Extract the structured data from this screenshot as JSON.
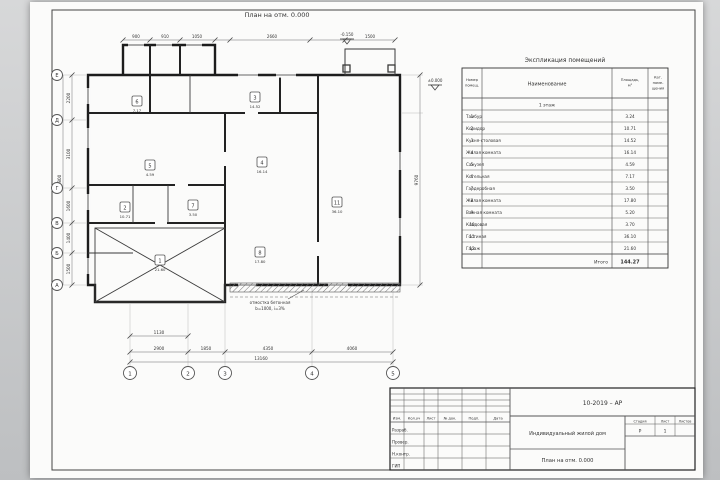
{
  "page": {
    "background": "#c6c8ca",
    "paper": "#fbfbfa"
  },
  "drawing_title": "План на отм. 0.000",
  "plan": {
    "axes_bottom": [
      "1",
      "2",
      "3",
      "4",
      "5"
    ],
    "axes_left": [
      "Е",
      "Д",
      "Г",
      "В",
      "Б",
      "А"
    ],
    "dims_top": [
      "900",
      "910",
      "1050",
      "2660",
      "1500"
    ],
    "dims_bottom": [
      "2900",
      "1850",
      "4350",
      "4060"
    ],
    "dim_bottom_total": "13160",
    "dim_extra": "1130",
    "dims_left": [
      "2200",
      "3100",
      "1600",
      "1400",
      "1500"
    ],
    "dim_left_total": "9800",
    "dim_right_total": "9760",
    "levels": [
      "±0.000",
      "-0.150"
    ],
    "note_line1": "отмостка бетонная",
    "note_line2": "b=1000, i=3%",
    "rooms": [
      {
        "n": "6",
        "a": "7.17"
      },
      {
        "n": "3",
        "a": "14.52"
      },
      {
        "n": "5",
        "a": "4.59"
      },
      {
        "n": "4",
        "a": "16.14"
      },
      {
        "n": "2",
        "a": "10.71"
      },
      {
        "n": "7",
        "a": "3.50"
      },
      {
        "n": "8",
        "a": "17.80"
      },
      {
        "n": "11",
        "a": "36.10"
      },
      {
        "n": "1",
        "a": "21.60"
      }
    ]
  },
  "spec_table": {
    "title": "Экспликация помещений",
    "col_num_1": "Номер",
    "col_num_2": "помещ.",
    "col_name": "Наименование",
    "col_area_1": "Площадь,",
    "col_area_2": "м²",
    "col_cat_1": "Кат.",
    "col_cat_2": "поме-",
    "col_cat_3": "щения",
    "section": "1 этаж",
    "rows": [
      {
        "num": "1",
        "name": "Тамбур",
        "area": "3.24"
      },
      {
        "num": "2",
        "name": "Коридор",
        "area": "10.71"
      },
      {
        "num": "3",
        "name": "Кухня-столовая",
        "area": "14.52"
      },
      {
        "num": "4",
        "name": "Жилая комната",
        "area": "16.14"
      },
      {
        "num": "5",
        "name": "Санузел",
        "area": "4.59"
      },
      {
        "num": "6",
        "name": "Котельная",
        "area": "7.17"
      },
      {
        "num": "7",
        "name": "Гардеробная",
        "area": "3.50"
      },
      {
        "num": "8",
        "name": "Жилая комната",
        "area": "17.80"
      },
      {
        "num": "9",
        "name": "Ванная комната",
        "area": "5.20"
      },
      {
        "num": "10",
        "name": "Кладовая",
        "area": "3.70"
      },
      {
        "num": "11",
        "name": "Гостиная",
        "area": "36.10"
      },
      {
        "num": "12",
        "name": "Гараж",
        "area": "21.60"
      }
    ],
    "total_label": "Итого",
    "total_area": "144.27"
  },
  "titleblock": {
    "doc_code": "10-2019 – АР",
    "col_izm": "Изм.",
    "col_kol": "Кол.уч",
    "col_list": "Лист",
    "col_doc": "№ док.",
    "col_podp": "Подп.",
    "col_data": "Дата",
    "role_1": "Разраб.",
    "role_2": "Провер.",
    "role_3": "Н.контр.",
    "role_4": "ГИП",
    "project": "Индивидуальный жилой дом",
    "sheet_title": "План на отм. 0.000",
    "stage_label": "Стадия",
    "sheet_label": "Лист",
    "sheets_label": "Листов",
    "stage": "Р",
    "sheet": "1",
    "sheets": ""
  }
}
